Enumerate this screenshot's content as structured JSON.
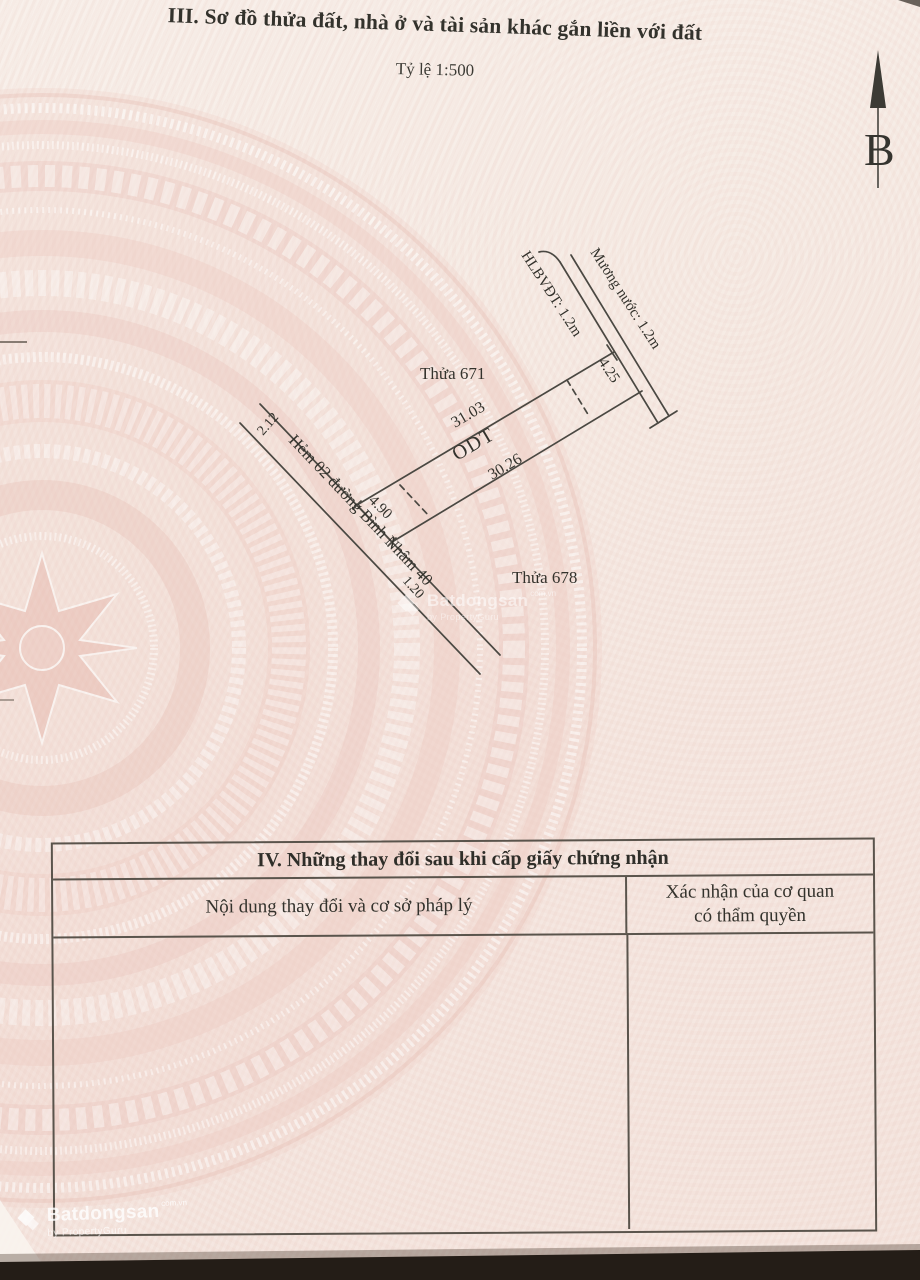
{
  "header": {
    "section_title": "III. Sơ đồ thửa đất, nhà ở và tài sản khác gắn liền với đất",
    "scale_label": "Tỷ lệ  1:500",
    "north_label": "B"
  },
  "diagram": {
    "parcel_top_label": "Thửa 671",
    "parcel_bottom_label": "Thửa 678",
    "zone_label": "ODT",
    "top_length": "31.03",
    "bottom_length": "30.26",
    "front_width": "4.90",
    "rear_width": "4.25",
    "street_dim_upper": "2.12",
    "street_dim_lower": "1.20",
    "street_label": "Hẻm 02 đường Bình Nhâm 40",
    "corridor_label": "HLBVĐT: 1.2m",
    "canal_label": "Mương nước: 1.2m"
  },
  "table4": {
    "title": "IV. Những thay đổi sau khi cấp giấy chứng nhận",
    "col1_header": "Nội dung thay đổi và cơ sở pháp lý",
    "col2_header_line1": "Xác nhận của cơ quan",
    "col2_header_line2": "có thẩm quyền"
  },
  "watermark": {
    "brand": "Batdongsan",
    "brand_suffix": "com.vn",
    "byline": "by PropertyGuru"
  },
  "colors": {
    "paper_pink": "#f5e8e1",
    "drum_pink": "#ecc6bd",
    "ink": "#3b3a34",
    "diagram_line": "#4a4842",
    "table_border": "#5a544c",
    "photo_edge_dark": "#241d17",
    "watermark_white": "#ffffff"
  }
}
